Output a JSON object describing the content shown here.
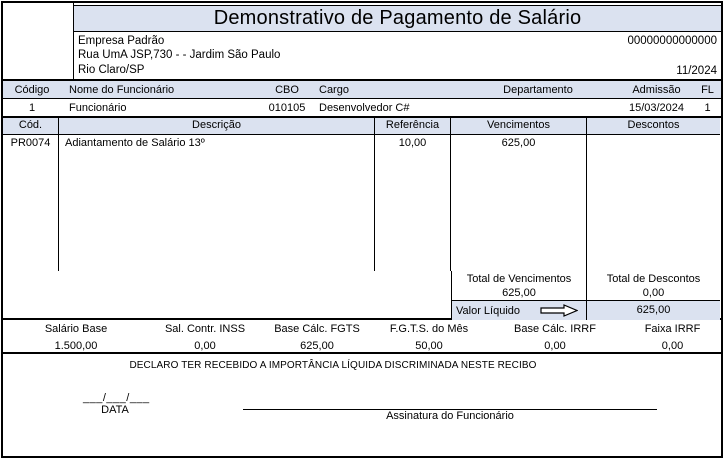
{
  "colors": {
    "header_bg": "#dbe2f0",
    "border": "#000000"
  },
  "header": {
    "title": "Demonstrativo de Pagamento de Salário",
    "company_name": "Empresa Padrão",
    "company_address": "Rua UmA JSP,730 -  - Jardim São Paulo",
    "company_city": "Rio Claro/SP",
    "company_number": "00000000000000",
    "period": "11/2024"
  },
  "employee": {
    "headers": {
      "codigo": "Código",
      "nome": "Nome do Funcionário",
      "cbo": "CBO",
      "cargo": "Cargo",
      "departamento": "Departamento",
      "admissao": "Admissão",
      "fl": "FL"
    },
    "values": {
      "codigo": "1",
      "nome": "Funcionário",
      "cbo": "010105",
      "cargo": "Desenvolvedor C#",
      "departamento": "",
      "admissao": "15/03/2024",
      "fl": "1"
    }
  },
  "items": {
    "headers": {
      "cod": "Cód.",
      "descricao": "Descrição",
      "referencia": "Referência",
      "vencimentos": "Vencimentos",
      "descontos": "Descontos"
    },
    "rows": [
      {
        "cod": "PR0074",
        "descricao": "Adiantamento de Salário 13º",
        "referencia": "10,00",
        "vencimentos": "625,00",
        "descontos": ""
      }
    ]
  },
  "totals": {
    "total_vencimentos_label": "Total de Vencimentos",
    "total_vencimentos_value": "625,00",
    "total_descontos_label": "Total de Descontos",
    "total_descontos_value": "0,00",
    "valor_liquido_label": "Valor Líquido",
    "valor_liquido_value": "625,00"
  },
  "bases": {
    "columns": [
      {
        "label": "Salário Base",
        "value": "1.500,00"
      },
      {
        "label": "Sal. Contr. INSS",
        "value": "0,00"
      },
      {
        "label": "Base Cálc. FGTS",
        "value": "625,00"
      },
      {
        "label": "F.G.T.S. do Mês",
        "value": "50,00"
      },
      {
        "label": "Base Cálc. IRRF",
        "value": "0,00"
      },
      {
        "label": "Faixa IRRF",
        "value": "0,00"
      }
    ]
  },
  "footer": {
    "declaration": "DECLARO TER RECEBIDO A IMPORTÂNCIA LÍQUIDA DISCRIMINADA NESTE RECIBO",
    "date_placeholder": "___/___/___",
    "date_label": "DATA",
    "signature_label": "Assinatura do Funcionário"
  }
}
